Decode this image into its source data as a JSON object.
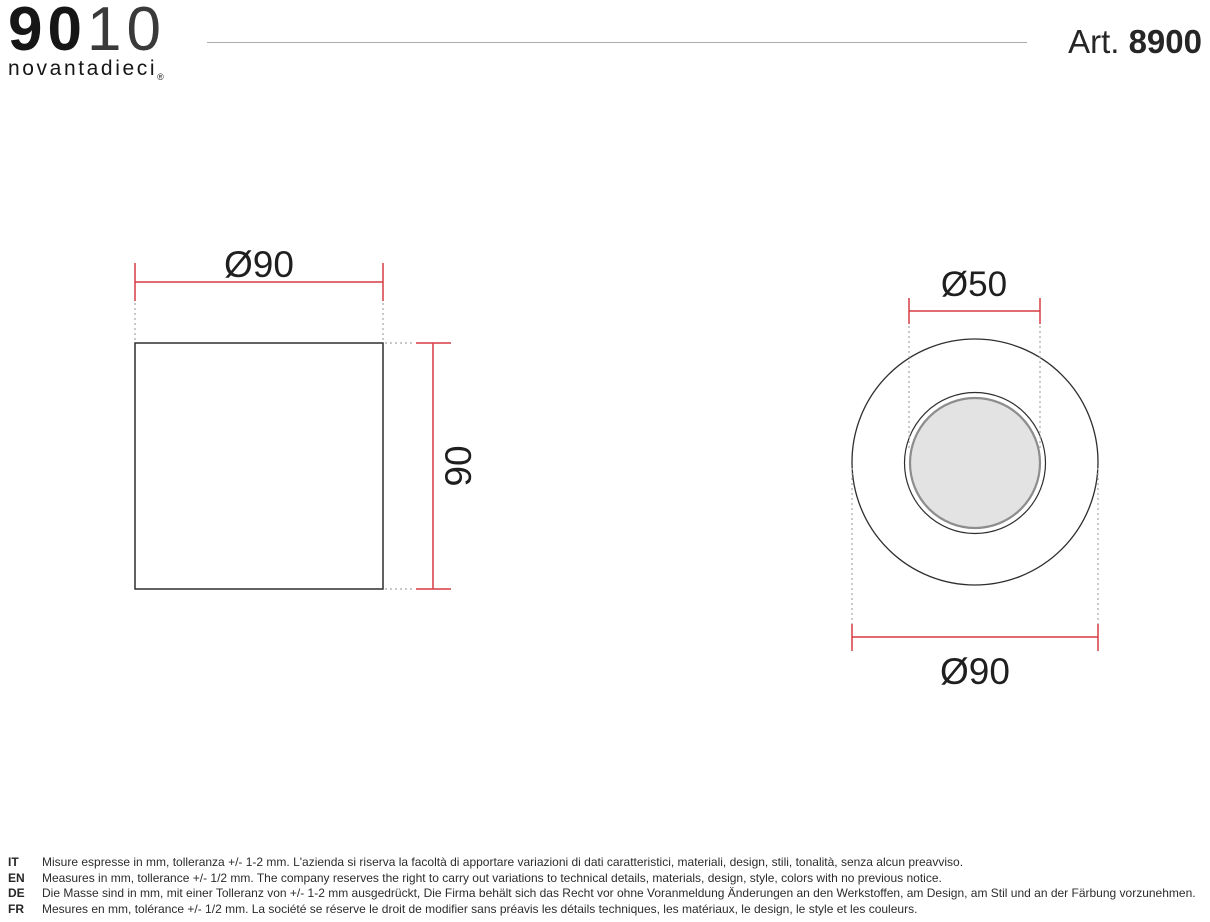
{
  "header": {
    "logo": {
      "digits_bold": "90",
      "digits_light": "10",
      "brand_name": "novantadieci",
      "registered_mark": "®"
    },
    "article": {
      "prefix": "Art. ",
      "number": "8900"
    }
  },
  "drawings": {
    "side_view": {
      "width_dimension": "Ø90",
      "height_dimension": "90"
    },
    "front_view": {
      "inner_dimension": "Ø50",
      "outer_dimension": "Ø90"
    }
  },
  "colors": {
    "dimension_red": "#d63c42",
    "outline_dark": "#2e2e2e",
    "extension_gray": "#a6a6a6",
    "disc_fill": "#e3e3e3",
    "disc_rim": "#8d8d8d",
    "divider_gray": "#ababab"
  },
  "footer": {
    "notes": [
      {
        "lang": "IT",
        "text": "Misure espresse in mm, tolleranza +/- 1-2 mm. L'azienda si riserva la facoltà di apportare variazioni di dati caratteristici, materiali, design, stili, tonalità, senza alcun preavviso."
      },
      {
        "lang": "EN",
        "text": "Measures in mm, tollerance +/- 1/2 mm. The company reserves the right to carry out variations to technical details, materials, design, style, colors with no previous notice."
      },
      {
        "lang": "DE",
        "text": "Die Masse sind in mm, mit einer Tolleranz von +/- 1-2 mm ausgedrückt, Die Firma behält sich das Recht vor ohne Voranmeldung Änderungen an den Werkstoffen, am Design, am Stil und an der Färbung vorzunehmen."
      },
      {
        "lang": "FR",
        "text": "Mesures en mm, tolérance +/- 1/2 mm. La société se réserve le droit de modifier sans préavis les détails techniques, les matériaux, le design, le style et les couleurs."
      }
    ]
  }
}
